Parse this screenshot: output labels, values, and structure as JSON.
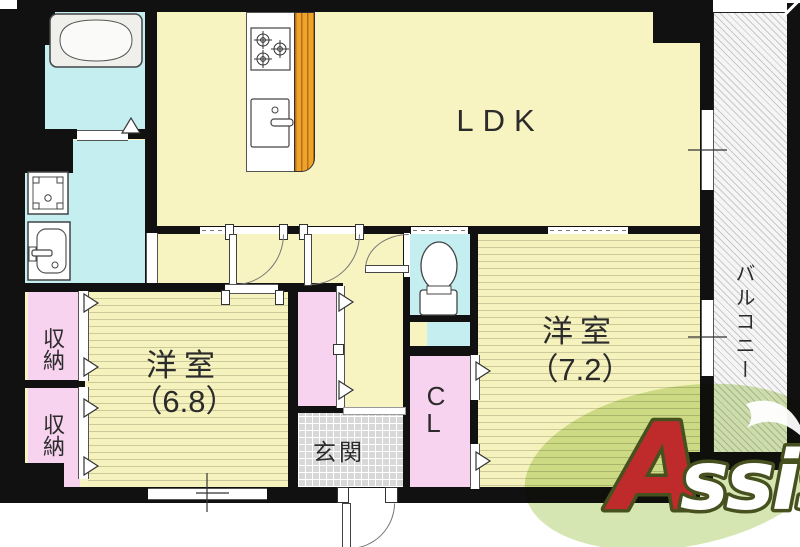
{
  "floorplan": {
    "rooms": {
      "ldk": {
        "label": "LDK"
      },
      "bedroom_left": {
        "name": "洋室",
        "size": "（6.8）"
      },
      "bedroom_right": {
        "name": "洋室",
        "size": "（7.2）"
      },
      "storage_top": {
        "label": "収納"
      },
      "storage_bottom": {
        "label": "収納"
      },
      "closet": {
        "line1": "C",
        "line2": "L"
      },
      "entrance": {
        "label": "玄関"
      },
      "balcony": {
        "label": "バルコニー"
      }
    },
    "colors": {
      "wall": "#111111",
      "room_yellow": "#f8f4c2",
      "flooring_line": "#ccc99a",
      "wet_area_cyan": "#c5eef1",
      "closet_pink": "#f7d3f0",
      "entrance_tile": "#d8d8d8",
      "balcony_hatch": "#c9c9c9",
      "kitchen_counter_orange": "#efa32a",
      "logo_green": "#cfe3a7",
      "logo_red": "#bf2b2b",
      "logo_outline": "#46511f"
    },
    "logo": {
      "initial": "A",
      "rest": "ssist"
    }
  }
}
